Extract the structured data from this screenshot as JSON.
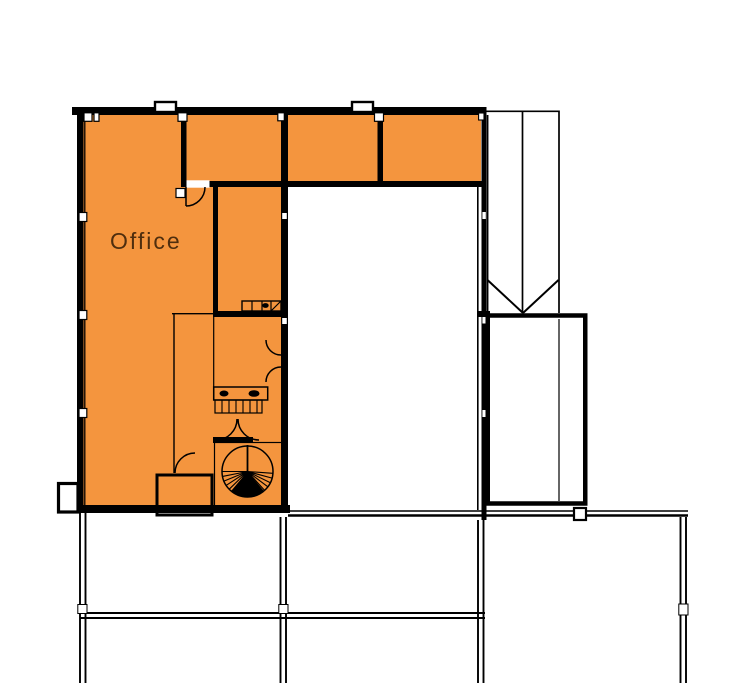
{
  "plan": {
    "office_label": "Office",
    "colors": {
      "highlight_fill": "#f4953e",
      "label_text": "#4f2e0e",
      "wall": "#000000",
      "background": "#ffffff"
    }
  }
}
